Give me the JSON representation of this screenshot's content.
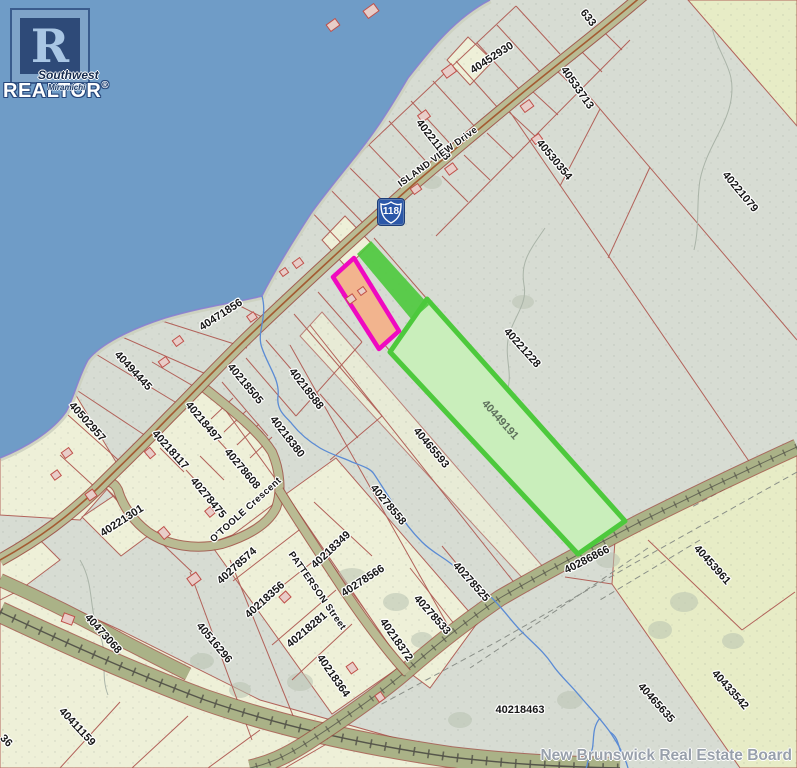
{
  "branding": {
    "logo_r": "R",
    "realtor_text": "REALTOR",
    "registered_mark": "®",
    "overlay_line1": "Southwest",
    "overlay_line2": "Miramichi",
    "board_watermark": "New Brunswick Real Estate Board"
  },
  "map": {
    "route_shield": {
      "number": "118"
    },
    "colors": {
      "water": "#6f9cc7",
      "land": "#d7dcd3",
      "parcel-yellow": "#eef0d8",
      "parcel-yellow2": "#e7ecc6",
      "line": "#b2625a",
      "road-fill": "#b9bb93",
      "road-casing": "#9c4f42",
      "road-center": "#a35b32",
      "corridor-fill": "#aab287",
      "rail": "#55554a",
      "stream": "#5b8bd4",
      "shore-purple": "#8a7fd0",
      "beach": "#ccd0bf",
      "magenta": "#ef09c0",
      "magenta-fill": "#f2b48e",
      "green": "#4dc93c",
      "green-fill": "#c9eebb",
      "label": "#161616",
      "label-green": "#5e705c",
      "watermark": "#98a0ab",
      "shield-blue": "#2b57a8"
    },
    "labels": [
      {
        "text": "40452930",
        "x": 492,
        "y": 58,
        "rot": -33,
        "kind": "parcel"
      },
      {
        "text": "633",
        "x": 588,
        "y": 18,
        "rot": 52,
        "kind": "parcel"
      },
      {
        "text": "40221178",
        "x": 433,
        "y": 140,
        "rot": 52,
        "kind": "parcel"
      },
      {
        "text": "40533713",
        "x": 577,
        "y": 88,
        "rot": 55,
        "kind": "parcel"
      },
      {
        "text": "40530354",
        "x": 554,
        "y": 160,
        "rot": 50,
        "kind": "parcel"
      },
      {
        "text": "40221079",
        "x": 740,
        "y": 192,
        "rot": 50,
        "kind": "parcel"
      },
      {
        "text": "ISLAND VIEW Drive",
        "x": 438,
        "y": 157,
        "rot": -36,
        "kind": "street"
      },
      {
        "text": "40471856",
        "x": 221,
        "y": 315,
        "rot": -33,
        "kind": "parcel"
      },
      {
        "text": "40494445",
        "x": 133,
        "y": 371,
        "rot": 47,
        "kind": "parcel"
      },
      {
        "text": "40502957",
        "x": 87,
        "y": 422,
        "rot": 48,
        "kind": "parcel"
      },
      {
        "text": "40218505",
        "x": 245,
        "y": 384,
        "rot": 50,
        "kind": "parcel"
      },
      {
        "text": "40218588",
        "x": 306,
        "y": 389,
        "rot": 52,
        "kind": "parcel"
      },
      {
        "text": "40218380",
        "x": 287,
        "y": 437,
        "rot": 52,
        "kind": "parcel"
      },
      {
        "text": "40218497",
        "x": 203,
        "y": 422,
        "rot": 50,
        "kind": "parcel"
      },
      {
        "text": "40218117",
        "x": 170,
        "y": 450,
        "rot": 48,
        "kind": "parcel"
      },
      {
        "text": "40278608",
        "x": 242,
        "y": 469,
        "rot": 50,
        "kind": "parcel"
      },
      {
        "text": "40278475",
        "x": 208,
        "y": 498,
        "rot": 50,
        "kind": "parcel"
      },
      {
        "text": "O'TOOLE Crescent",
        "x": 246,
        "y": 510,
        "rot": -42,
        "kind": "street"
      },
      {
        "text": "40221301",
        "x": 122,
        "y": 521,
        "rot": -33,
        "kind": "parcel"
      },
      {
        "text": "40473068",
        "x": 103,
        "y": 634,
        "rot": 48,
        "kind": "parcel"
      },
      {
        "text": "40516296",
        "x": 214,
        "y": 643,
        "rot": 50,
        "kind": "parcel"
      },
      {
        "text": "40411159",
        "x": 77,
        "y": 727,
        "rot": 47,
        "kind": "parcel"
      },
      {
        "text": "36",
        "x": 6,
        "y": 741,
        "rot": 45,
        "kind": "parcel"
      },
      {
        "text": "40465593",
        "x": 431,
        "y": 448,
        "rot": 50,
        "kind": "parcel"
      },
      {
        "text": "40278558",
        "x": 388,
        "y": 505,
        "rot": 50,
        "kind": "parcel"
      },
      {
        "text": "40449191",
        "x": 500,
        "y": 420,
        "rot": 48,
        "kind": "parcel-highlight"
      },
      {
        "text": "40221228",
        "x": 522,
        "y": 348,
        "rot": 48,
        "kind": "parcel"
      },
      {
        "text": "40286866",
        "x": 587,
        "y": 560,
        "rot": -27,
        "kind": "parcel"
      },
      {
        "text": "40278574",
        "x": 237,
        "y": 566,
        "rot": -42,
        "kind": "parcel"
      },
      {
        "text": "PATTERSON Street",
        "x": 317,
        "y": 591,
        "rot": 55,
        "kind": "street"
      },
      {
        "text": "40218356",
        "x": 265,
        "y": 600,
        "rot": -42,
        "kind": "parcel"
      },
      {
        "text": "40218281",
        "x": 307,
        "y": 630,
        "rot": -40,
        "kind": "parcel"
      },
      {
        "text": "40218364",
        "x": 333,
        "y": 676,
        "rot": 55,
        "kind": "parcel"
      },
      {
        "text": "40218349",
        "x": 331,
        "y": 550,
        "rot": -43,
        "kind": "parcel"
      },
      {
        "text": "40278566",
        "x": 363,
        "y": 581,
        "rot": -33,
        "kind": "parcel"
      },
      {
        "text": "40218372",
        "x": 396,
        "y": 640,
        "rot": 55,
        "kind": "parcel"
      },
      {
        "text": "40278533",
        "x": 432,
        "y": 615,
        "rot": 48,
        "kind": "parcel"
      },
      {
        "text": "40278525",
        "x": 471,
        "y": 582,
        "rot": 48,
        "kind": "parcel"
      },
      {
        "text": "40218463",
        "x": 520,
        "y": 710,
        "rot": 0,
        "kind": "parcel"
      },
      {
        "text": "40453961",
        "x": 712,
        "y": 565,
        "rot": 48,
        "kind": "parcel"
      },
      {
        "text": "40433542",
        "x": 730,
        "y": 690,
        "rot": 48,
        "kind": "parcel"
      },
      {
        "text": "40465635",
        "x": 656,
        "y": 703,
        "rot": 48,
        "kind": "parcel"
      }
    ]
  }
}
